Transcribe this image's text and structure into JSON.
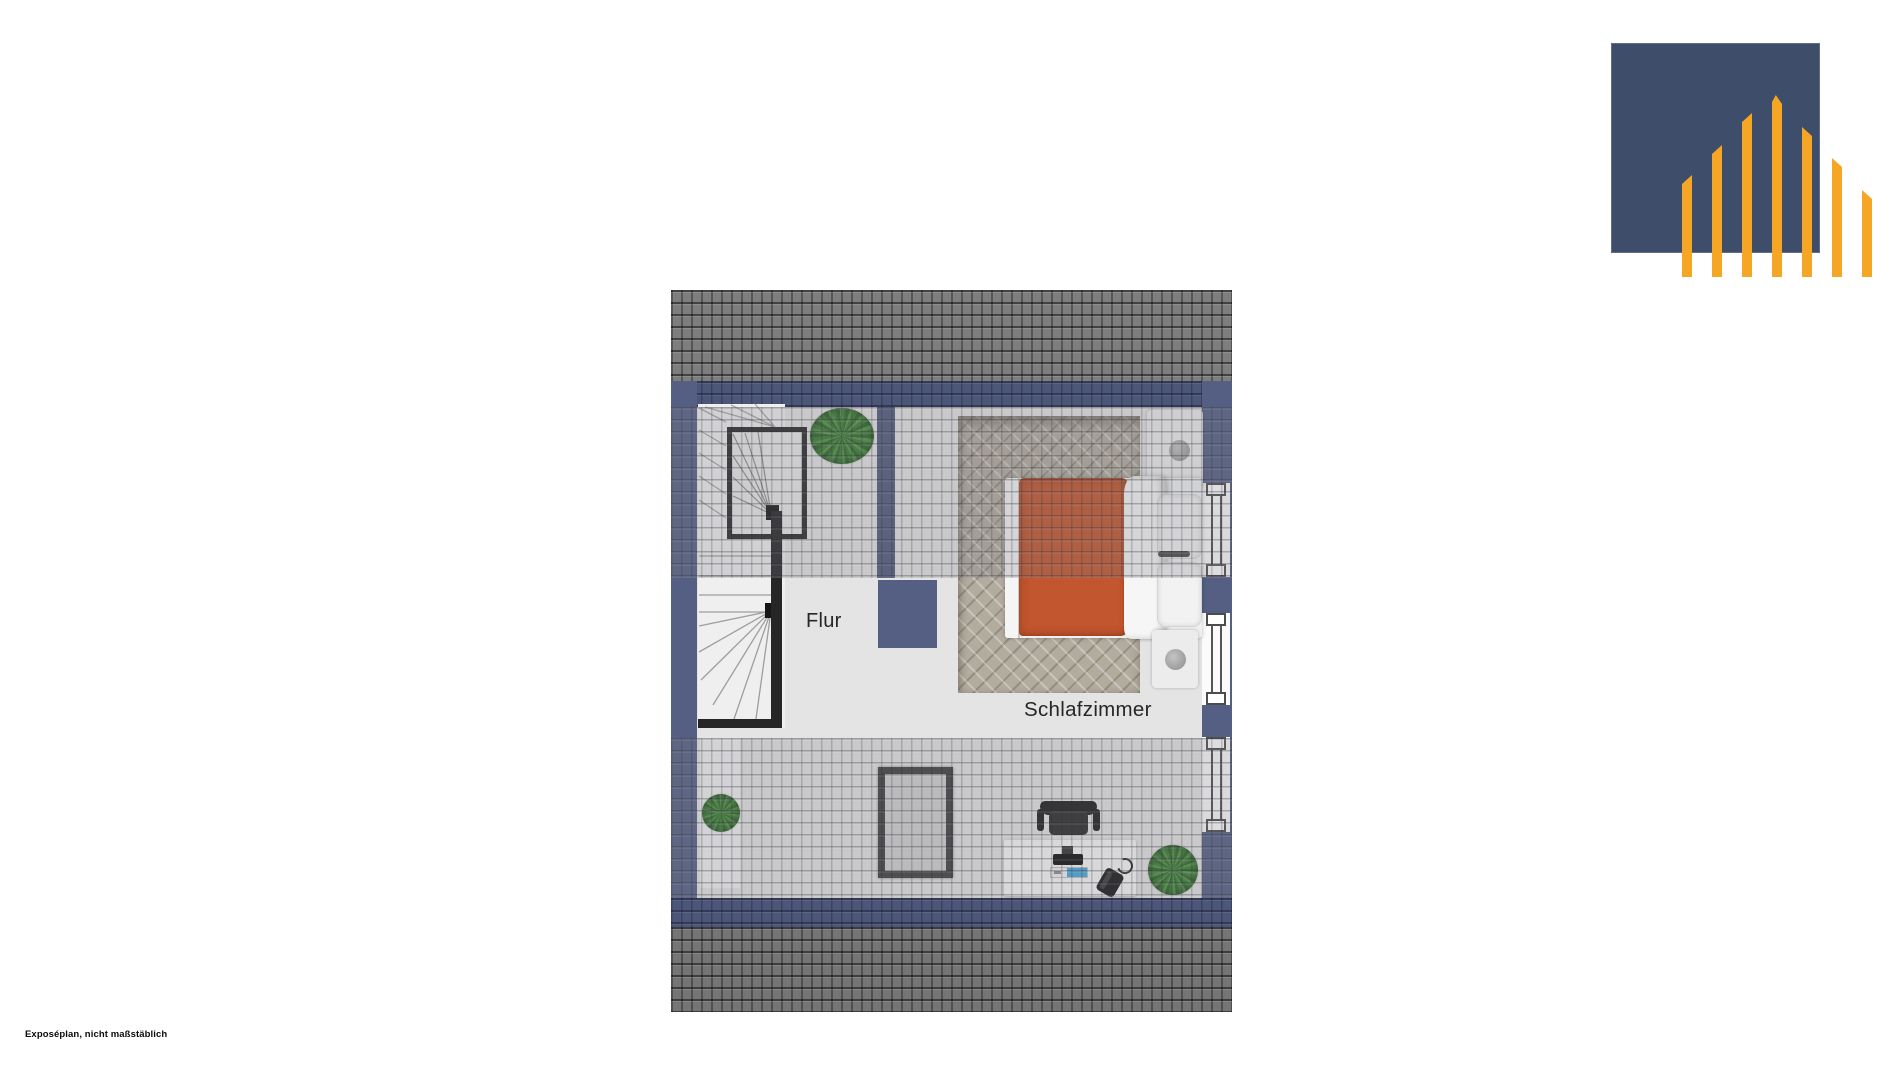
{
  "document": {
    "type": "floorplan-expose",
    "disclaimer": "Exposéplan, nicht maßstäblich",
    "background": "#ffffff"
  },
  "floorplan": {
    "room_labels": [
      {
        "id": "flur",
        "text": "Flur"
      },
      {
        "id": "schlafzimmer",
        "text": "Schlafzimmer"
      }
    ],
    "windows_on_right_wall": 3,
    "furniture": [
      "staircase",
      "double-bed",
      "cabinet-with-lamp",
      "nightstand-with-lamp",
      "roof-window-frame",
      "desk",
      "office-chair",
      "monitor",
      "keyboard",
      "desk-phone",
      "potted-plant-top",
      "potted-plant-left",
      "potted-plant-right"
    ],
    "colors": {
      "wall_navy": "#545f83",
      "roof_gray": "#7e7e7e",
      "floor_light": "#e4e4e4",
      "rug_beige": "#b2ab9e",
      "bed_duvet_orange": "#c1562f",
      "plant_green": "#3a7d33",
      "keyboard_accent_blue": "#45a9dc",
      "stair_rail_black": "#262626"
    }
  },
  "logo": {
    "type": "house-bars-logo",
    "square_color": "#3e4d6a",
    "bar_color": "#f5a624",
    "bar_count": 7
  }
}
